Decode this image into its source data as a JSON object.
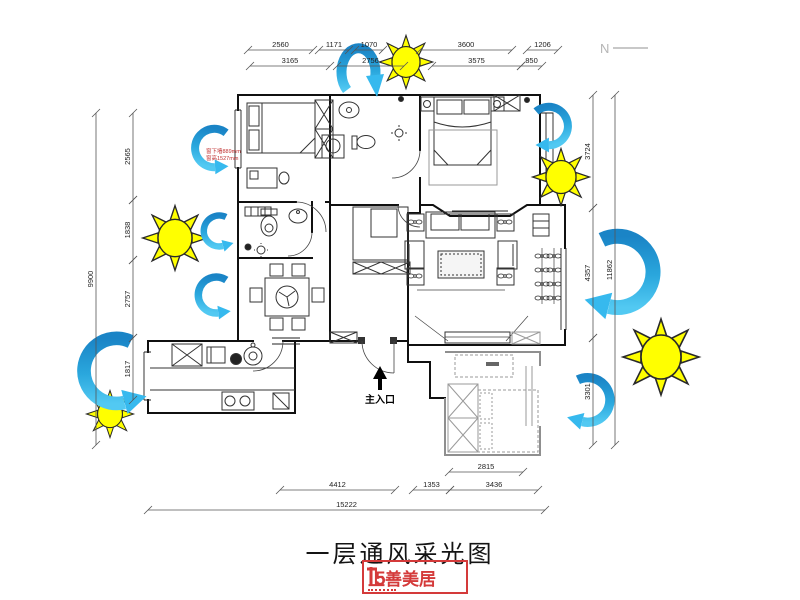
{
  "meta": {
    "title": "一层通风采光图",
    "north_label": "N"
  },
  "plan": {
    "entrance_label": "主入口",
    "window_note_line1": "窗下墙889mm",
    "window_note_line2": "窗高1527mm"
  },
  "logo": {
    "name": "上善美居"
  },
  "legend": {
    "sun_meaning": "采光",
    "arrow_meaning": "通风",
    "sun_color": "#ffff00",
    "arrow_color_dark": "#1a84c6",
    "arrow_color_light": "#52c9f2",
    "accent_red": "#d43a3a"
  },
  "dimensions": {
    "horizontal": [
      {
        "y": 50,
        "segs": [
          {
            "x1": 248,
            "x2": 313,
            "v": "2560"
          },
          {
            "x1": 319,
            "x2": 349,
            "v": "1171"
          },
          {
            "x1": 355,
            "x2": 383,
            "v": "1070"
          },
          {
            "x1": 420,
            "x2": 512,
            "v": "3600"
          },
          {
            "x1": 527,
            "x2": 558,
            "v": "1206"
          }
        ]
      },
      {
        "y": 66,
        "segs": [
          {
            "x1": 250,
            "x2": 330,
            "v": "3165"
          },
          {
            "x1": 337,
            "x2": 404,
            "v": "2756"
          },
          {
            "x1": 432,
            "x2": 521,
            "v": "3575"
          },
          {
            "x1": 521,
            "x2": 542,
            "v": "850"
          }
        ]
      },
      {
        "y": 472,
        "segs": [
          {
            "x1": 449,
            "x2": 523,
            "v": "2815"
          }
        ]
      },
      {
        "y": 490,
        "segs": [
          {
            "x1": 280,
            "x2": 395,
            "v": "4412"
          },
          {
            "x1": 413,
            "x2": 450,
            "v": "1353"
          },
          {
            "x1": 450,
            "x2": 538,
            "v": "3436"
          }
        ]
      },
      {
        "y": 510,
        "segs": [
          {
            "x1": 148,
            "x2": 545,
            "v": "15222"
          }
        ]
      }
    ],
    "vertical": [
      {
        "x": 133,
        "segs": [
          {
            "y1": 113,
            "y2": 200,
            "v": "2565"
          },
          {
            "y1": 200,
            "y2": 260,
            "v": "1838"
          },
          {
            "y1": 260,
            "y2": 338,
            "v": "2757"
          },
          {
            "y1": 338,
            "y2": 400,
            "v": "1817"
          }
        ]
      },
      {
        "x": 96,
        "segs": [
          {
            "y1": 113,
            "y2": 445,
            "v": "9900"
          }
        ]
      },
      {
        "x": 593,
        "segs": [
          {
            "y1": 95,
            "y2": 208,
            "v": "3724"
          },
          {
            "y1": 208,
            "y2": 338,
            "v": "4357"
          },
          {
            "y1": 338,
            "y2": 445,
            "v": "3301"
          }
        ]
      },
      {
        "x": 615,
        "segs": [
          {
            "y1": 95,
            "y2": 445,
            "v": "11862"
          }
        ]
      }
    ]
  }
}
